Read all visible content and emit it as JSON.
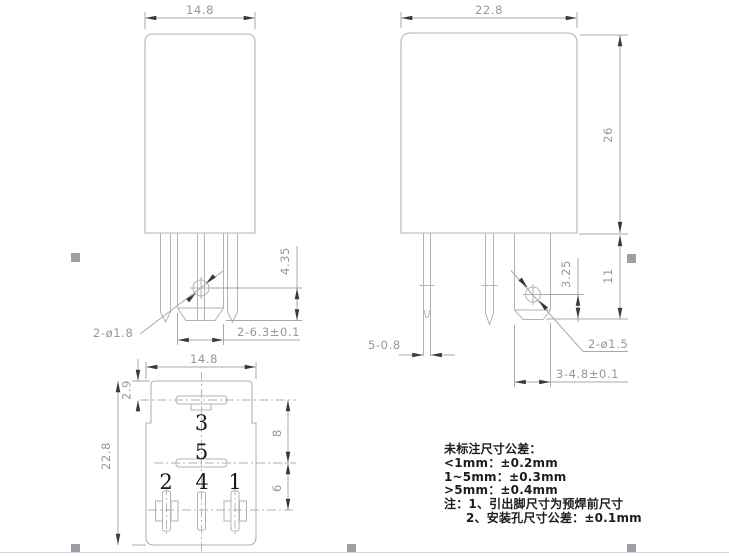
{
  "front_view": {
    "width": "14.8",
    "hole_callout": "2-ø1.8",
    "hole_to_base": "4.35",
    "bracket_width": "2-6.3±0.1"
  },
  "side_view": {
    "width": "22.8",
    "body_height": "26",
    "hole_to_base": "3.25",
    "base_to_body": "11",
    "pin_thickness": "5-0.8",
    "hole_callout": "2-ø1.5",
    "bracket_width": "3-4.8±0.1"
  },
  "bottom_view": {
    "width": "14.8",
    "edge_to_pin3": "2.9",
    "height": "22.8",
    "pin3_to_pin5": "8",
    "pin5_to_bottom_row": "6",
    "pins": {
      "pin3": "3",
      "pin5": "5",
      "pin2": "2",
      "pin4": "4",
      "pin1": "1"
    }
  },
  "notes": {
    "title": "未标注尺寸公差：",
    "tol_lt1": "<1mm：±0.2mm",
    "tol_1to5": "1~5mm：±0.3mm",
    "tol_gt5": ">5mm：±0.4mm",
    "note1": "注：1、引出脚尺寸为预焊前尺寸",
    "note2": "2、安装孔尺寸公差：±0.1mm"
  },
  "colors": {
    "line": "#b3b3b3",
    "dim_text": "#979797",
    "arrow": "#3a3a3a",
    "label_text": "#161616",
    "handle": "#9aa0a6",
    "page_edge": "#cdd5da"
  }
}
